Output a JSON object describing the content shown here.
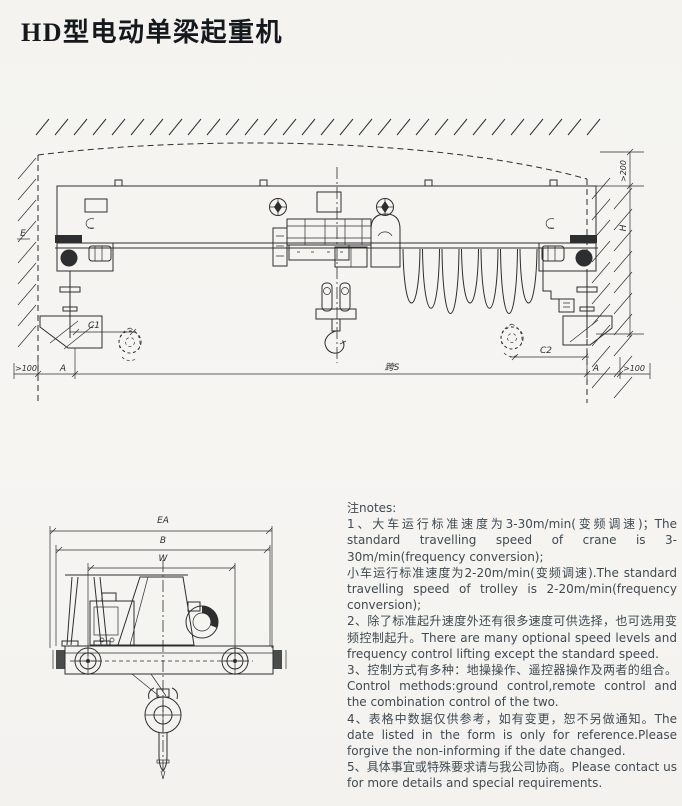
{
  "page": {
    "title": "HD型电动单梁起重机",
    "background": "#f5f4f1",
    "ink_color": "#2c2e2f",
    "notes_color": "#3f4a52"
  },
  "main_drawing": {
    "description": "front elevation of HD electric single girder crane under building roof",
    "labels": {
      "wall_clearance_left": "E",
      "headroom_top_right": ">200",
      "lift_height": "H",
      "hook_approach_left": "C1",
      "hook_approach_right": "C2",
      "rail_offset_left": "A",
      "rail_offset_right": "A",
      "end_margin_left": ">100",
      "end_margin_right": ">100",
      "span": "跨S"
    }
  },
  "end_view": {
    "description": "end view of crane end carriage with hoist section and hook",
    "labels": {
      "overall_width": "EA",
      "end_carriage_length": "B",
      "wheel_base": "W"
    }
  },
  "notes": {
    "heading": "注notes:",
    "items": [
      "1、大车运行标准速度为3-30m/min(变频调速)；The standard travelling speed of crane is 3-30m/min(frequency conversion);",
      "小车运行标准速度为2-20m/min(变频调速).The standard travelling speed of trolley is 2-20m/min(frequency conversion);",
      "2、除了标准起升速度外还有很多速度可供选择，也可选用变频控制起升。There are many optional speed levels and frequency control lifting except the standard speed.",
      "3、控制方式有多种：地操操作、遥控器操作及两者的组合。Control methods:ground control,remote control and the combination control of the two.",
      "4、表格中数据仅供参考，如有变更，恕不另做通知。The date listed in the form is only for reference.Please forgive the non-informing if the date changed.",
      "5、具体事宜或特殊要求请与我公司协商。Please contact us for more details and special requirements."
    ]
  }
}
